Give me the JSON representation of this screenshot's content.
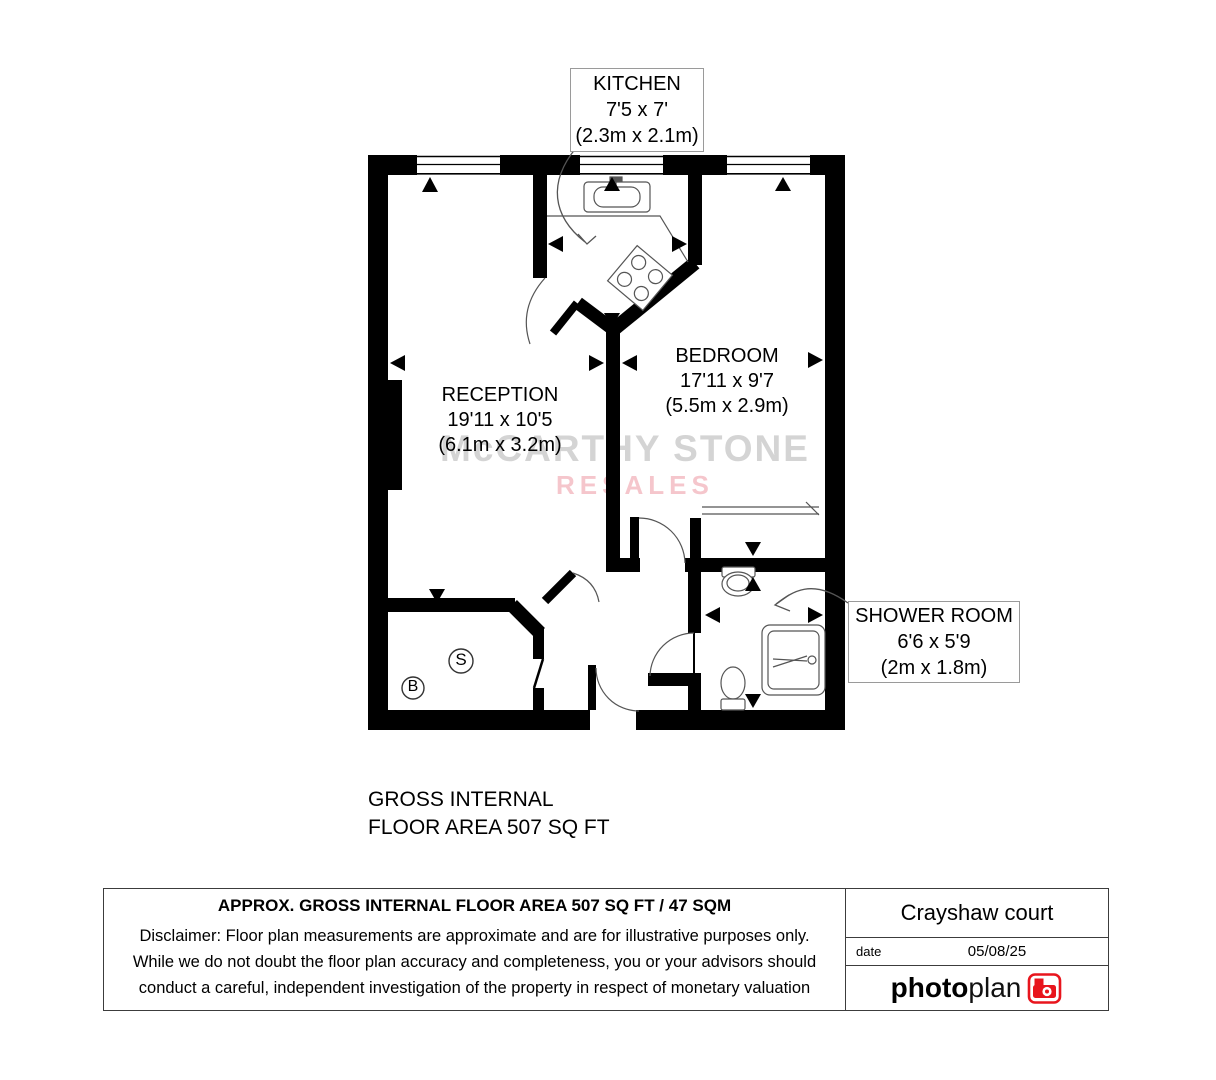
{
  "floorplan": {
    "kitchen": {
      "name": "KITCHEN",
      "imperial": "7'5 x 7'",
      "metric": "(2.3m x 2.1m)"
    },
    "reception": {
      "name": "RECEPTION",
      "imperial": "19'11 x 10'5",
      "metric": "(6.1m x 3.2m)"
    },
    "bedroom": {
      "name": "BEDROOM",
      "imperial": "17'11 x 9'7",
      "metric": "(5.5m x 2.9m)"
    },
    "shower_room": {
      "name": "SHOWER ROOM",
      "imperial": "6'6 x 5'9",
      "metric": "(2m x 1.8m)"
    },
    "storage_label": "S",
    "boiler_label": "B",
    "watermark_line1": "McCARTHY STONE",
    "watermark_line2": "RESALES",
    "gross_area_line1": "GROSS INTERNAL",
    "gross_area_line2": "FLOOR AREA 507 SQ FT"
  },
  "footer": {
    "approx_area": "APPROX. GROSS INTERNAL FLOOR AREA 507 SQ FT /  47 SQM",
    "disclaimer_line1": "Disclaimer: Floor plan measurements are approximate and are for illustrative purposes only.",
    "disclaimer_line2": "While we do not doubt the floor plan accuracy and completeness, you or your advisors should",
    "disclaimer_line3": "conduct a careful, independent investigation of the property in respect of monetary valuation",
    "property_name": "Crayshaw court",
    "date_label": "date",
    "date_value": "05/08/25",
    "brand_photo": "photo",
    "brand_plan": "plan"
  },
  "colors": {
    "watermark_gray": "#d4d4d4",
    "watermark_pink": "#f5c6cc",
    "brand_red": "#e8151d",
    "wall_black": "#000000"
  }
}
